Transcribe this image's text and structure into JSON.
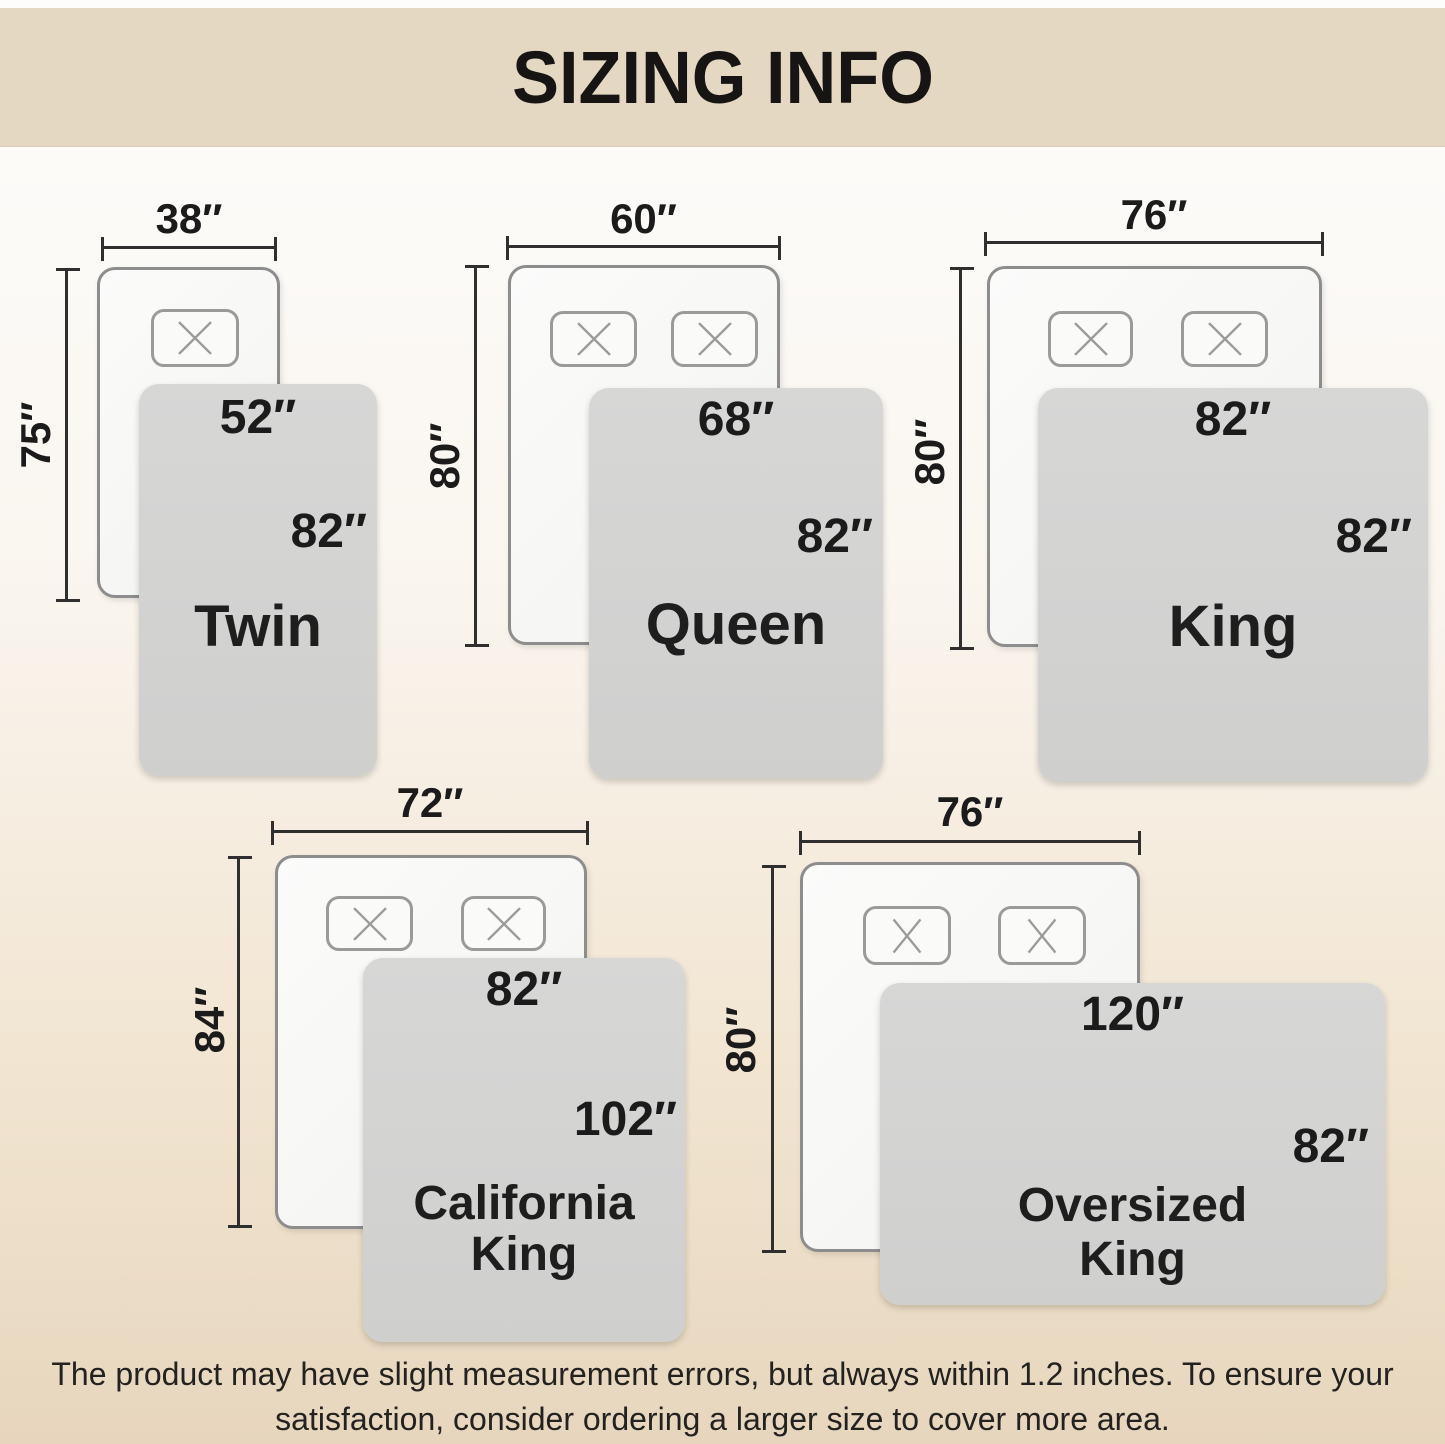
{
  "title": "SIZING INFO",
  "footer": "The product may have slight measurement errors, but always within 1.2 inches. To ensure your satisfaction, consider ordering a larger size to cover more area.",
  "sizes": [
    {
      "name": "Twin",
      "mattress_width": "38″",
      "mattress_height": "75″",
      "blanket_width": "52″",
      "blanket_height": "82″",
      "pillows": 1
    },
    {
      "name": "Queen",
      "mattress_width": "60″",
      "mattress_height": "80″",
      "blanket_width": "68″",
      "blanket_height": "82″",
      "pillows": 2
    },
    {
      "name": "King",
      "mattress_width": "76″",
      "mattress_height": "80″",
      "blanket_width": "82″",
      "blanket_height": "82″",
      "pillows": 2
    },
    {
      "name": "California King",
      "mattress_width": "72″",
      "mattress_height": "84″",
      "blanket_width": "82″",
      "blanket_height": "102″",
      "pillows": 2
    },
    {
      "name": "Oversized King",
      "mattress_width": "76″",
      "mattress_height": "80″",
      "blanket_width": "120″",
      "blanket_height": "82″",
      "pillows": 2
    }
  ],
  "colors": {
    "banner_bg": "#e4d8c3",
    "background_bottom": "#e7d6bd",
    "blanket_gray": "#d3d3d2",
    "mattress_white": "#f7f7f6",
    "dimension_line": "#2f2f2f",
    "text": "#1b1b1b"
  }
}
